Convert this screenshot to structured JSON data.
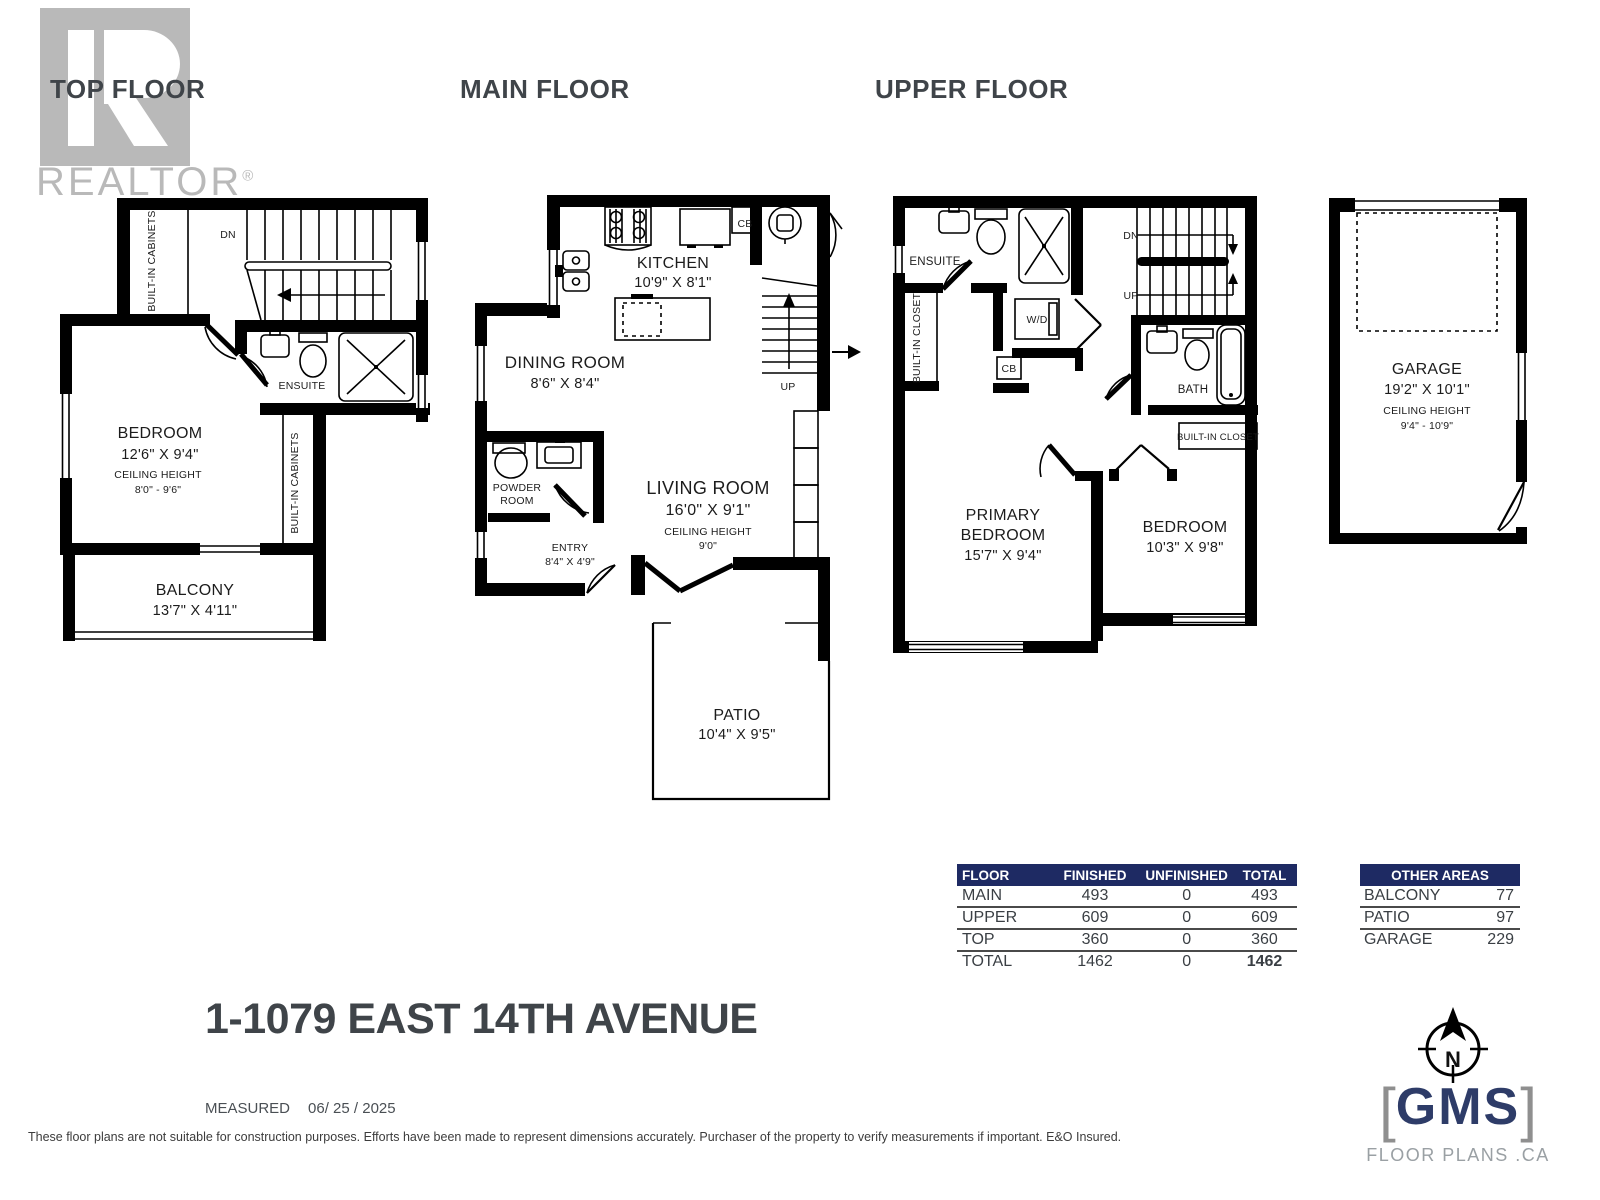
{
  "branding": {
    "logo_word": "REALTOR",
    "reg": "®"
  },
  "headings": {
    "top_floor": "TOP FLOOR",
    "main_floor": "MAIN FLOOR",
    "upper_floor": "UPPER FLOOR"
  },
  "labels": {
    "dn": "DN",
    "up": "UP",
    "cb": "CB",
    "wd": "W/D"
  },
  "top_floor": {
    "built_in_cabinets": "BUILT-IN CABINETS",
    "built_in_cabinets_2": "BUILT-IN CABINETS",
    "ensuite": "ENSUITE",
    "bedroom_name": "BEDROOM",
    "bedroom_dims": "12'6\" X 9'4\"",
    "ceiling_label": "CEILING HEIGHT",
    "ceiling_value": "8'0\" - 9'6\"",
    "balcony_name": "BALCONY",
    "balcony_dims": "13'7\" X 4'11\""
  },
  "main_floor": {
    "kitchen_name": "KITCHEN",
    "kitchen_dims": "10'9\" X 8'1\"",
    "dining_name": "DINING ROOM",
    "dining_dims": "8'6\" X 8'4\"",
    "living_name": "LIVING ROOM",
    "living_dims": "16'0\" X 9'1\"",
    "ceiling_label": "CEILING HEIGHT",
    "ceiling_value": "9'0\"",
    "powder_line1": "POWDER",
    "powder_line2": "ROOM",
    "entry_name": "ENTRY",
    "entry_dims": "8'4\" X 4'9\"",
    "patio_name": "PATIO",
    "patio_dims": "10'4\" X 9'5\""
  },
  "upper_floor": {
    "ensuite": "ENSUITE",
    "built_in_closet": "BUILT-IN CLOSET",
    "built_in_closet_2": "BUILT-IN CLOSET",
    "bath": "BATH",
    "primary_line1": "PRIMARY",
    "primary_line2": "BEDROOM",
    "primary_dims": "15'7\" X 9'4\"",
    "bedroom_name": "BEDROOM",
    "bedroom_dims": "10'3\" X 9'8\""
  },
  "garage": {
    "name": "GARAGE",
    "dims": "19'2\" X 10'1\"",
    "ceiling_label": "CEILING HEIGHT",
    "ceiling_value": "9'4\" - 10'9\""
  },
  "area_table": {
    "headers": [
      "FLOOR",
      "FINISHED",
      "UNFINISHED",
      "TOTAL"
    ],
    "rows": [
      [
        "MAIN",
        "493",
        "0",
        "493"
      ],
      [
        "UPPER",
        "609",
        "0",
        "609"
      ],
      [
        "TOP",
        "360",
        "0",
        "360"
      ]
    ],
    "total_row": [
      "TOTAL",
      "1462",
      "0",
      "1462"
    ]
  },
  "other_areas": {
    "header": "OTHER AREAS",
    "rows": [
      [
        "BALCONY",
        "77"
      ],
      [
        "PATIO",
        "97"
      ],
      [
        "GARAGE",
        "229"
      ]
    ]
  },
  "address": "1-1079 EAST 14TH AVENUE",
  "measured_label": "MEASURED",
  "measured_date": "06/ 25 / 2025",
  "disclaimer": "These floor plans are not suitable for construction purposes. Efforts have been made to represent dimensions accurately.  Purchaser of the property to verify measurements if important.  E&O Insured.",
  "gms": {
    "bracket_left": "[",
    "name": "GMS",
    "bracket_right": "]",
    "tagline": "FLOOR PLANS .CA",
    "compass_n": "N"
  },
  "colors": {
    "navy": "#1e2a63",
    "text_dark": "#3f4449",
    "logo_gray": "#b9b9b9",
    "gms_navy": "#2e3c68"
  }
}
